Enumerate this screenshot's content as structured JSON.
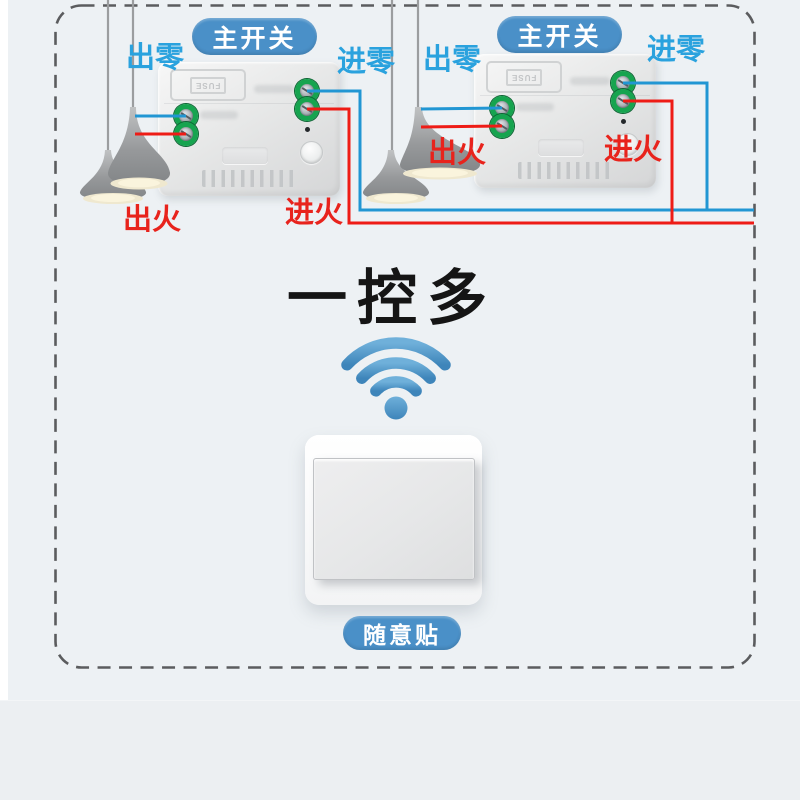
{
  "title": {
    "text": "一控多"
  },
  "receivers": [
    {
      "badge": "主开关",
      "neutral_out": "出零",
      "neutral_in": "进零",
      "live_out": "出火",
      "live_in": "进火",
      "fuse": "FUSE"
    },
    {
      "badge": "主开关",
      "neutral_out": "出零",
      "neutral_in": "进零",
      "live_out": "出火",
      "live_in": "进火",
      "fuse": "FUSE"
    }
  ],
  "switch": {
    "badge": "随意贴"
  },
  "icons": {
    "wifi": "wifi-signal-icon"
  },
  "colors": {
    "background": "#edf1f4",
    "border_dash": "#5b5c5e",
    "accent_blue": "#4a90c8",
    "label_blue": "#2aa2de",
    "label_red": "#e8231c",
    "wire_blue": "#2196d3",
    "wire_red": "#ee1c16",
    "terminal_green": "#16a44f",
    "wifi_blue": "#4a94c8"
  }
}
